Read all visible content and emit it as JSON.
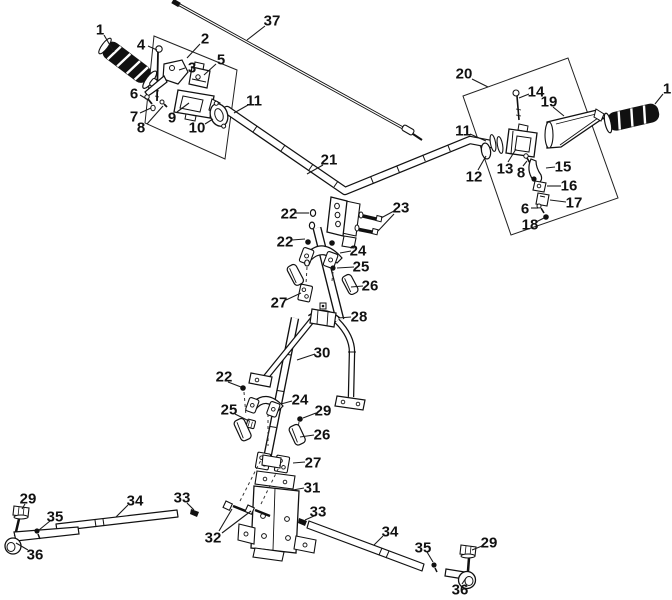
{
  "figure": {
    "type": "exploded-parts-diagram",
    "background": "#ffffff",
    "line_color": "#1a1a1a",
    "part_numbers_visible": [
      "1",
      "2",
      "3",
      "4",
      "5",
      "6",
      "7",
      "8",
      "9",
      "10",
      "11",
      "12",
      "13",
      "14",
      "15",
      "16",
      "17",
      "18",
      "19",
      "20",
      "21",
      "22",
      "23",
      "24",
      "25",
      "26",
      "27",
      "28",
      "29",
      "30",
      "31",
      "32",
      "33",
      "34",
      "35",
      "36",
      "37"
    ]
  },
  "callouts": [
    {
      "num": "1",
      "x": 100,
      "y": 29,
      "leaders": [
        [
          104,
          35,
          114,
          52
        ]
      ]
    },
    {
      "num": "2",
      "x": 205,
      "y": 38,
      "leaders": [
        [
          200,
          44,
          187,
          58
        ]
      ]
    },
    {
      "num": "3",
      "x": 192,
      "y": 67,
      "leaders": [
        [
          185,
          68,
          179,
          70
        ]
      ]
    },
    {
      "num": "4",
      "x": 141,
      "y": 44,
      "leaders": [
        [
          148,
          46,
          157,
          50
        ]
      ]
    },
    {
      "num": "5",
      "x": 221,
      "y": 59,
      "leaders": [
        [
          216,
          64,
          204,
          75
        ]
      ]
    },
    {
      "num": "6",
      "x": 134,
      "y": 93,
      "leaders": [
        [
          140,
          95,
          150,
          101
        ]
      ]
    },
    {
      "num": "7",
      "x": 134,
      "y": 116,
      "leaders": [
        [
          140,
          113,
          151,
          108
        ]
      ]
    },
    {
      "num": "8",
      "x": 141,
      "y": 127,
      "leaders": [
        [
          147,
          124,
          163,
          106
        ]
      ]
    },
    {
      "num": "9",
      "x": 172,
      "y": 117,
      "leaders": [
        [
          177,
          112,
          189,
          103
        ]
      ]
    },
    {
      "num": "10",
      "x": 197,
      "y": 127,
      "leaders": [
        [
          205,
          124,
          213,
          119
        ]
      ]
    },
    {
      "num": "11",
      "x": 254,
      "y": 100,
      "leaders": [
        [
          248,
          105,
          234,
          113
        ]
      ]
    },
    {
      "num": "37",
      "x": 272,
      "y": 20,
      "leaders": [
        [
          265,
          26,
          247,
          40
        ]
      ]
    },
    {
      "num": "21",
      "x": 329,
      "y": 159,
      "leaders": [
        [
          323,
          165,
          307,
          174
        ]
      ]
    },
    {
      "num": "20",
      "x": 464,
      "y": 73,
      "leaders": [
        [
          472,
          79,
          488,
          87
        ]
      ]
    },
    {
      "num": "14",
      "x": 536,
      "y": 91,
      "leaders": [
        [
          529,
          94,
          519,
          98
        ]
      ]
    },
    {
      "num": "19",
      "x": 549,
      "y": 101,
      "leaders": [
        [
          553,
          107,
          564,
          116
        ]
      ]
    },
    {
      "num": "1",
      "x": 667,
      "y": 88,
      "leaders": [
        [
          663,
          94,
          655,
          104
        ]
      ]
    },
    {
      "num": "11",
      "x": 463,
      "y": 130,
      "leaders": [
        [
          470,
          134,
          486,
          141
        ]
      ]
    },
    {
      "num": "12",
      "x": 474,
      "y": 176,
      "leaders": [
        [
          478,
          170,
          486,
          156
        ]
      ]
    },
    {
      "num": "13",
      "x": 505,
      "y": 168,
      "leaders": [
        [
          508,
          162,
          516,
          149
        ]
      ]
    },
    {
      "num": "8",
      "x": 521,
      "y": 172,
      "leaders": [
        [
          523,
          166,
          527,
          161
        ]
      ]
    },
    {
      "num": "15",
      "x": 563,
      "y": 166,
      "leaders": [
        [
          555,
          167,
          546,
          168
        ]
      ]
    },
    {
      "num": "16",
      "x": 569,
      "y": 185,
      "leaders": [
        [
          561,
          186,
          547,
          186
        ]
      ]
    },
    {
      "num": "17",
      "x": 574,
      "y": 202,
      "leaders": [
        [
          566,
          202,
          550,
          200
        ]
      ]
    },
    {
      "num": "6",
      "x": 525,
      "y": 208,
      "leaders": [
        [
          531,
          208,
          538,
          208
        ]
      ]
    },
    {
      "num": "18",
      "x": 530,
      "y": 224,
      "leaders": [
        [
          536,
          222,
          544,
          218
        ]
      ]
    },
    {
      "num": "22",
      "x": 289,
      "y": 213,
      "leaders": [
        [
          296,
          213,
          309,
          213
        ]
      ]
    },
    {
      "num": "23",
      "x": 401,
      "y": 207,
      "leaders": [
        [
          394,
          211,
          381,
          218
        ],
        [
          394,
          214,
          378,
          231
        ]
      ]
    },
    {
      "num": "22",
      "x": 285,
      "y": 241,
      "leaders": [
        [
          292,
          240,
          305,
          239
        ]
      ]
    },
    {
      "num": "24",
      "x": 358,
      "y": 250,
      "leaders": [
        [
          351,
          251,
          340,
          253
        ]
      ]
    },
    {
      "num": "25",
      "x": 361,
      "y": 266,
      "leaders": [
        [
          354,
          267,
          337,
          268
        ]
      ]
    },
    {
      "num": "26",
      "x": 370,
      "y": 285,
      "leaders": [
        [
          363,
          286,
          351,
          287
        ]
      ]
    },
    {
      "num": "27",
      "x": 279,
      "y": 302,
      "leaders": [
        [
          286,
          300,
          301,
          293
        ]
      ]
    },
    {
      "num": "28",
      "x": 359,
      "y": 316,
      "leaders": [
        [
          351,
          317,
          338,
          318
        ]
      ]
    },
    {
      "num": "30",
      "x": 322,
      "y": 352,
      "leaders": [
        [
          315,
          354,
          297,
          360
        ]
      ]
    },
    {
      "num": "22",
      "x": 224,
      "y": 376,
      "leaders": [
        [
          228,
          382,
          241,
          387
        ]
      ]
    },
    {
      "num": "25",
      "x": 229,
      "y": 409,
      "leaders": [
        [
          235,
          414,
          249,
          421
        ]
      ]
    },
    {
      "num": "24",
      "x": 300,
      "y": 399,
      "leaders": [
        [
          292,
          401,
          281,
          404
        ]
      ]
    },
    {
      "num": "29",
      "x": 323,
      "y": 410,
      "leaders": [
        [
          316,
          413,
          303,
          418
        ]
      ]
    },
    {
      "num": "26",
      "x": 322,
      "y": 434,
      "leaders": [
        [
          314,
          435,
          300,
          437
        ]
      ]
    },
    {
      "num": "27",
      "x": 313,
      "y": 462,
      "leaders": [
        [
          305,
          462,
          293,
          463
        ]
      ]
    },
    {
      "num": "31",
      "x": 312,
      "y": 487,
      "leaders": [
        [
          304,
          488,
          293,
          490
        ]
      ]
    },
    {
      "num": "32",
      "x": 213,
      "y": 537,
      "leaders": [
        [
          219,
          531,
          232,
          509
        ],
        [
          222,
          533,
          251,
          511
        ]
      ]
    },
    {
      "num": "33",
      "x": 318,
      "y": 511,
      "leaders": [
        [
          314,
          516,
          305,
          520
        ]
      ]
    },
    {
      "num": "29",
      "x": 28,
      "y": 498,
      "leaders": [
        [
          25,
          504,
          22,
          509
        ]
      ]
    },
    {
      "num": "34",
      "x": 135,
      "y": 500,
      "leaders": [
        [
          128,
          505,
          116,
          517
        ]
      ]
    },
    {
      "num": "33",
      "x": 182,
      "y": 497,
      "leaders": [
        [
          187,
          503,
          194,
          510
        ]
      ]
    },
    {
      "num": "35",
      "x": 55,
      "y": 516,
      "leaders": [
        [
          50,
          521,
          39,
          530
        ]
      ]
    },
    {
      "num": "36",
      "x": 35,
      "y": 554,
      "leaders": [
        [
          28,
          550,
          16,
          543
        ]
      ]
    },
    {
      "num": "34",
      "x": 390,
      "y": 531,
      "leaders": [
        [
          383,
          536,
          374,
          545
        ]
      ]
    },
    {
      "num": "35",
      "x": 423,
      "y": 547,
      "leaders": [
        [
          427,
          552,
          433,
          562
        ]
      ]
    },
    {
      "num": "29",
      "x": 489,
      "y": 542,
      "leaders": [
        [
          482,
          546,
          472,
          550
        ]
      ]
    },
    {
      "num": "36",
      "x": 460,
      "y": 589,
      "leaders": [
        [
          462,
          584,
          466,
          578
        ]
      ]
    }
  ]
}
